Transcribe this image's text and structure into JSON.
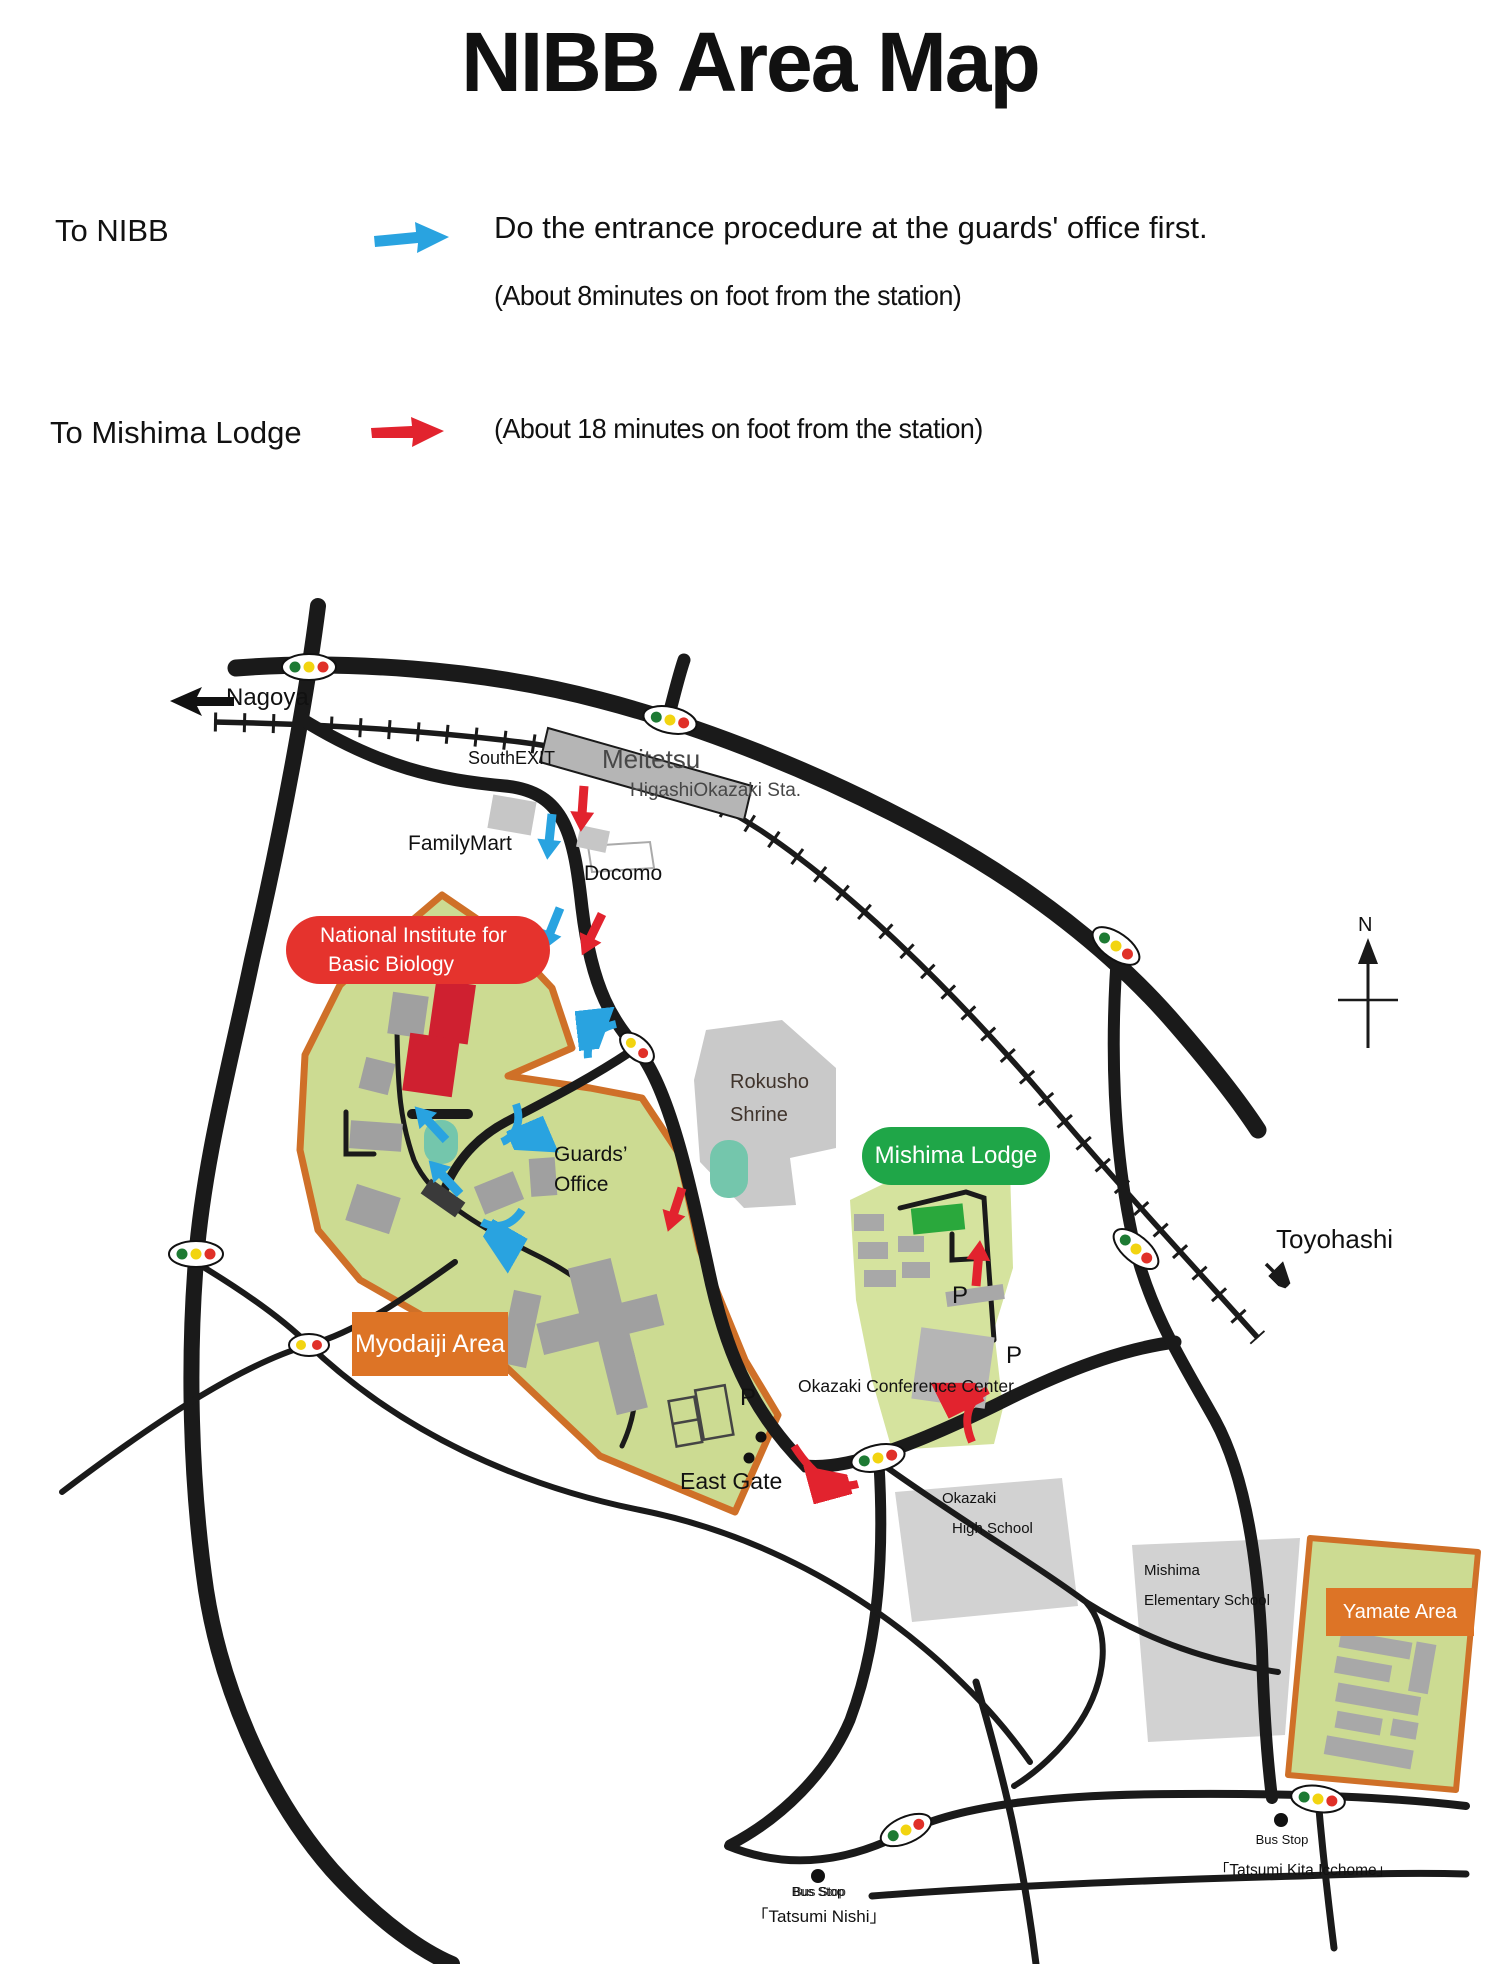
{
  "title": "NIBB Area Map",
  "legend": {
    "nibb": {
      "label": "To NIBB",
      "note": "Do the entrance procedure at the guards' office first.",
      "time": "(About 8minutes on foot from the station)"
    },
    "lodge": {
      "label": "To Mishima Lodge",
      "time": "(About 18 minutes on foot from the station)"
    }
  },
  "map": {
    "labels": {
      "nagoya": "Nagoya",
      "south_exit": "SouthEXIT",
      "meitetsu": "Meitetsu",
      "station": "HigashiOkazaki Sta.",
      "family_mart": "FamilyMart",
      "docomo": "Docomo",
      "nibb_line1": "National Institute for",
      "nibb_line2": "Basic Biology",
      "rokusho_line1": "Rokusho",
      "rokusho_line2": "Shrine",
      "mishima_lodge": "Mishima Lodge",
      "guards_line1": "Guards’",
      "guards_line2": "Office",
      "myodaiji": "Myodaiji Area",
      "conference": "Okazaki Conference Center",
      "east_gate": "East Gate",
      "high_school_line1": "Okazaki",
      "high_school_line2": "High School",
      "elementary_line1": "Mishima",
      "elementary_line2": "Elementary School",
      "yamate": "Yamate Area",
      "toyohashi": "Toyohashi",
      "parking": "P",
      "north": "N",
      "bus_stop": "Bus Stop",
      "tatsumi_nishi": "「Tatsumi Nishi」",
      "tatsumi_kita": "「Tatsumi Kita Icchome」"
    },
    "colors": {
      "road_black": "#1a1a1a",
      "campus_green": "#ccdb92",
      "lodge_green": "#d5e39e",
      "shrine_gray": "#c9c9c9",
      "school_gray": "#d2d2d2",
      "building_gray": "#a0a0a0",
      "building_red": "#cf2030",
      "bright_green_building": "#2aa83c",
      "pond_teal": "#74c6ac",
      "border_orange": "#cf7028",
      "nibb_badge_red": "#e5332d",
      "lodge_badge_green": "#1fa648",
      "area_badge_orange": "#dd7426",
      "route_blue": "#29a3e0",
      "route_red": "#e2232e",
      "signal_green": "#1d7a33",
      "signal_yellow": "#f2d410",
      "signal_red": "#e03028",
      "marker_yellow": "#ffe014"
    }
  }
}
